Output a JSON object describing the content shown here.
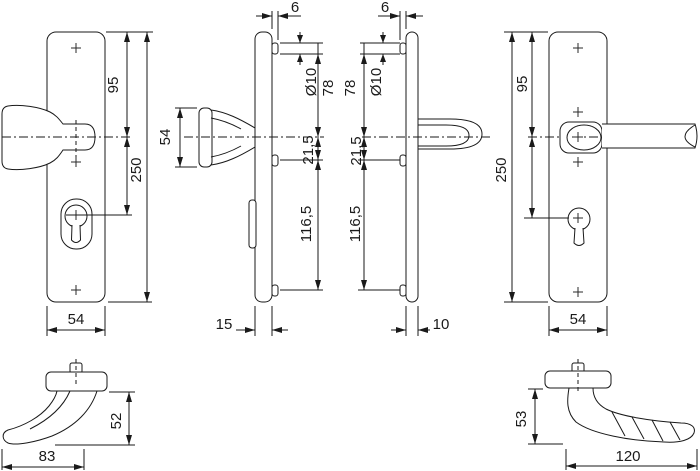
{
  "colors": {
    "line": "#1a1a1a",
    "background": "#ffffff"
  },
  "views": {
    "knob_plate_front": {
      "dims": {
        "top_to_handle": "95",
        "plate_length": "250",
        "plate_width": "54"
      }
    },
    "knob_plate_side": {
      "dims": {
        "stud_protrusion": "6",
        "stud_diameter": "Ø10",
        "stud_to_handle": "78",
        "handle_to_stud": "21,5",
        "stud_spacing": "116,5",
        "plate_depth": "15",
        "knob_height": "54"
      }
    },
    "lever_plate_side": {
      "dims": {
        "stud_protrusion": "6",
        "stud_diameter": "Ø10",
        "stud_to_handle": "78",
        "handle_to_stud": "21,5",
        "stud_spacing": "116,5",
        "plate_depth": "10"
      }
    },
    "lever_plate_front": {
      "dims": {
        "top_to_handle": "95",
        "plate_length": "250",
        "plate_width": "54"
      }
    },
    "knob_profile": {
      "dims": {
        "height": "52",
        "length": "83"
      }
    },
    "lever_profile": {
      "dims": {
        "height": "53",
        "length": "120"
      }
    }
  }
}
